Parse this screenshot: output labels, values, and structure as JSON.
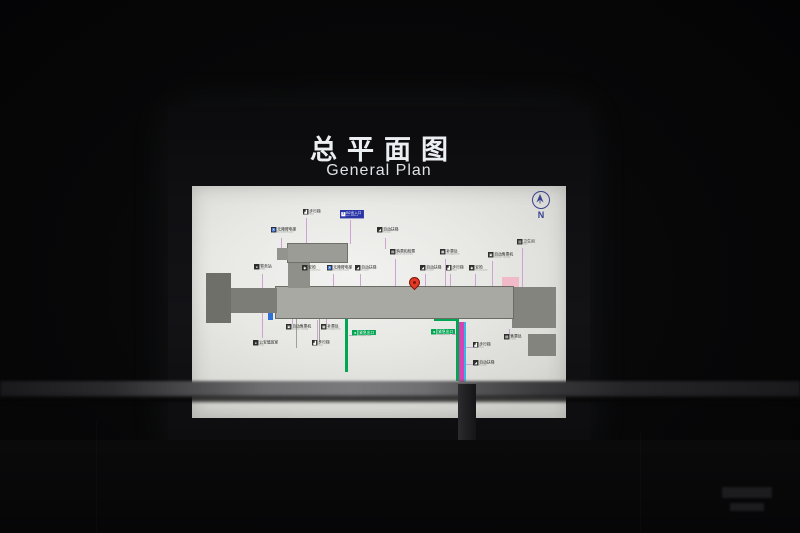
{
  "sign": {
    "title_zh": "总平面图",
    "title_en": "General Plan"
  },
  "compass": {
    "label": "N"
  },
  "colors": {
    "accent_green": "#00a651",
    "accent_magenta": "#d841b1",
    "accent_cyan": "#38b6e6",
    "accent_orange": "#f08424",
    "exit_blue": "#2a35a8",
    "pin_red": "#e23a26",
    "compass_blue": "#39418f"
  },
  "map": {
    "labels": [
      {
        "x": 303,
        "y": 209,
        "zh": "步行梯",
        "en": "Stairs",
        "icon": "stairs-icon",
        "style": "dark"
      },
      {
        "x": 340,
        "y": 210,
        "zh": "B2出入口",
        "en": "Exit / Entrance",
        "icon": "exit-badge-icon",
        "badge": "2",
        "style": "blue"
      },
      {
        "x": 271,
        "y": 227,
        "zh": "无障碍电梯",
        "en": "Accessible Elevator",
        "icon": "accessible-elevator-icon",
        "style": "dark"
      },
      {
        "x": 377,
        "y": 227,
        "zh": "自动扶梯",
        "en": "Escalator",
        "icon": "escalator-icon",
        "style": "dark"
      },
      {
        "x": 517,
        "y": 239,
        "zh": "卫生间",
        "en": "Toilet",
        "icon": "toilet-icon",
        "style": "dark"
      },
      {
        "x": 390,
        "y": 249,
        "zh": "购票和检票",
        "en": "Buy & Check Tickets",
        "icon": "ticket-check-icon",
        "style": "dark"
      },
      {
        "x": 440,
        "y": 249,
        "zh": "补票处",
        "en": "Fare Adjustment",
        "icon": "fare-adjust-icon",
        "style": "dark"
      },
      {
        "x": 488,
        "y": 252,
        "zh": "自动售票机",
        "en": "Automatic Ticketing",
        "icon": "ticket-machine-icon",
        "style": "dark"
      },
      {
        "x": 254,
        "y": 264,
        "zh": "警务站",
        "en": "Police",
        "icon": "police-icon",
        "style": "dark"
      },
      {
        "x": 302,
        "y": 265,
        "zh": "安检",
        "en": "Security Check",
        "icon": "security-check-icon",
        "style": "dark"
      },
      {
        "x": 327,
        "y": 265,
        "zh": "无障碍电梯",
        "en": "Accessible Elevator",
        "icon": "accessible-elevator-icon",
        "style": "dark"
      },
      {
        "x": 355,
        "y": 265,
        "zh": "自动扶梯",
        "en": "Escalator",
        "icon": "escalator-icon",
        "style": "dark"
      },
      {
        "x": 420,
        "y": 265,
        "zh": "自动扶梯",
        "en": "Escalator",
        "icon": "escalator-icon",
        "style": "dark"
      },
      {
        "x": 446,
        "y": 265,
        "zh": "步行梯",
        "en": "Stairs",
        "icon": "stairs-icon",
        "style": "dark"
      },
      {
        "x": 469,
        "y": 265,
        "zh": "安检",
        "en": "Security Check",
        "icon": "security-check-icon",
        "style": "dark"
      },
      {
        "x": 286,
        "y": 324,
        "zh": "自动售票机",
        "en": "Automatic Ticketing",
        "icon": "ticket-machine-icon",
        "style": "dark"
      },
      {
        "x": 321,
        "y": 324,
        "zh": "补票处",
        "en": "Fare Adjustment",
        "icon": "fare-adjust-icon",
        "style": "dark"
      },
      {
        "x": 253,
        "y": 340,
        "zh": "公安值班室",
        "en": "Police",
        "icon": "police-icon",
        "style": "dark"
      },
      {
        "x": 312,
        "y": 340,
        "zh": "步行梯",
        "en": "Stairs",
        "icon": "stairs-icon",
        "style": "dark"
      },
      {
        "x": 352,
        "y": 330,
        "zh": "紧急出口",
        "en": "Emergency Exit",
        "icon": "running-man-icon",
        "style": "green"
      },
      {
        "x": 431,
        "y": 329,
        "zh": "紧急出口",
        "en": "Emergency Exit",
        "icon": "running-man-icon",
        "style": "green"
      },
      {
        "x": 473,
        "y": 342,
        "zh": "步行梯",
        "en": "Stairs",
        "icon": "stairs-icon",
        "style": "dark"
      },
      {
        "x": 473,
        "y": 360,
        "zh": "自动扶梯",
        "en": "Escalator",
        "icon": "escalator-icon",
        "style": "dark"
      },
      {
        "x": 504,
        "y": 334,
        "zh": "售票处",
        "en": "Tickets",
        "icon": "ticket-office-icon",
        "style": "dark"
      }
    ],
    "icon_glyphs": {
      "stairs-icon": "▟",
      "exit-badge-icon": "2",
      "accessible-elevator-icon": "♿",
      "escalator-icon": "◢",
      "toilet-icon": "▥",
      "ticket-check-icon": "▤",
      "fare-adjust-icon": "▦",
      "ticket-machine-icon": "▣",
      "police-icon": "●",
      "security-check-icon": "◉",
      "running-man-icon": "◄",
      "ticket-office-icon": "▤"
    },
    "shapes": [
      {
        "name": "west-block",
        "x": 206,
        "y": 273,
        "w": 25,
        "h": 50,
        "f": "#6f6f69"
      },
      {
        "name": "west-walkway",
        "x": 230,
        "y": 288,
        "w": 47,
        "h": 25,
        "f": "#7d7d77"
      },
      {
        "name": "platform-west-stub",
        "x": 277,
        "y": 248,
        "w": 11,
        "h": 12,
        "f": "#94948e"
      },
      {
        "name": "platform-wing",
        "x": 288,
        "y": 244,
        "w": 59,
        "h": 18,
        "f": "#9c9c96",
        "s": "#70706a"
      },
      {
        "name": "platform-connector",
        "x": 288,
        "y": 261,
        "w": 22,
        "h": 27,
        "f": "#90908a"
      },
      {
        "name": "platform-edge-cyan",
        "x": 292,
        "y": 245,
        "w": 45,
        "h": 5,
        "f": "#38b6e6"
      },
      {
        "name": "platform-train-magenta",
        "x": 292,
        "y": 250,
        "w": 42,
        "h": 5,
        "f": "#d841b1"
      },
      {
        "name": "concourse",
        "x": 276,
        "y": 287,
        "w": 237,
        "h": 31,
        "f": "#a9a9a3",
        "s": "#6c6c66"
      },
      {
        "name": "east-block",
        "x": 512,
        "y": 287,
        "w": 44,
        "h": 41,
        "f": "#84847e"
      },
      {
        "name": "east-pink-room",
        "x": 502,
        "y": 277,
        "w": 17,
        "h": 11,
        "f": "#f0bac8"
      },
      {
        "name": "southeast-block",
        "x": 528,
        "y": 334,
        "w": 28,
        "h": 22,
        "f": "#84847e"
      },
      {
        "name": "south-corridor-wall",
        "x": 345,
        "y": 318,
        "w": 3,
        "h": 54,
        "f": "#00a651"
      },
      {
        "name": "exit-corridor-top",
        "x": 434,
        "y": 318,
        "w": 25,
        "h": 3,
        "f": "#00a651"
      },
      {
        "name": "exit-corridor-left",
        "x": 456,
        "y": 320,
        "w": 3,
        "h": 61,
        "f": "#00a651"
      },
      {
        "name": "exit-escalator",
        "x": 459,
        "y": 322,
        "w": 4.5,
        "h": 60,
        "f": "#d841b1"
      },
      {
        "name": "exit-escalator-edge",
        "x": 463.5,
        "y": 322,
        "w": 2,
        "h": 60,
        "f": "#38b6e6"
      },
      {
        "name": "gate-green-west",
        "x": 271,
        "y": 292,
        "w": 4,
        "h": 14,
        "f": "#00a651"
      },
      {
        "name": "booth-blue-west",
        "x": 268,
        "y": 309,
        "w": 5,
        "h": 11,
        "f": "#2f6fd8"
      },
      {
        "name": "tvm-magenta-west",
        "x": 316,
        "y": 299,
        "w": 17,
        "h": 6,
        "f": "#d841b1"
      },
      {
        "name": "kiosk-orange-west",
        "x": 337,
        "y": 306,
        "w": 5,
        "h": 5,
        "f": "#f08424"
      },
      {
        "name": "fare-gates-west",
        "x": 352,
        "y": 299,
        "w": 17,
        "h": 5,
        "f": "#38b6e6"
      },
      {
        "name": "fare-gates-east",
        "x": 420,
        "y": 299,
        "w": 14,
        "h": 6,
        "f": "#38b6e6"
      },
      {
        "name": "kiosk-orange-east",
        "x": 443,
        "y": 303,
        "w": 5,
        "h": 5,
        "f": "#f08424"
      },
      {
        "name": "tvm-magenta-east",
        "x": 448,
        "y": 298,
        "w": 14,
        "h": 6,
        "f": "#d841b1"
      },
      {
        "name": "gate-green-east",
        "x": 506,
        "y": 293,
        "w": 4,
        "h": 15,
        "f": "#00a651"
      },
      {
        "name": "gate-blue-a",
        "x": 293,
        "y": 296,
        "w": 6,
        "h": 4,
        "f": "#38b6e6"
      },
      {
        "name": "gate-blue-b",
        "x": 308,
        "y": 286,
        "w": 7,
        "h": 5,
        "f": "#5b8dd8"
      },
      {
        "name": "gate-blue-c",
        "x": 383,
        "y": 290,
        "w": 6,
        "h": 5,
        "f": "#5b8dd8"
      },
      {
        "name": "booth-gray",
        "x": 401,
        "y": 291,
        "w": 5,
        "h": 5,
        "f": "#9aa4b4"
      },
      {
        "name": "corridor-line-a",
        "x": 296,
        "y": 318,
        "w": 1,
        "h": 30,
        "f": "#a0a09a"
      },
      {
        "name": "corridor-line-b",
        "x": 319,
        "y": 318,
        "w": 1,
        "h": 24,
        "f": "#a0a09a"
      }
    ],
    "leaders": [
      {
        "x": 306,
        "y": 218,
        "dir": "v",
        "len": 26
      },
      {
        "x": 350,
        "y": 220,
        "dir": "v",
        "len": 24
      },
      {
        "x": 281,
        "y": 238,
        "dir": "v",
        "len": 12
      },
      {
        "x": 385,
        "y": 238,
        "dir": "v",
        "len": 11
      },
      {
        "x": 522,
        "y": 248,
        "dir": "v",
        "len": 39
      },
      {
        "x": 395,
        "y": 259,
        "dir": "v",
        "len": 40
      },
      {
        "x": 445,
        "y": 259,
        "dir": "v",
        "len": 39
      },
      {
        "x": 492,
        "y": 261,
        "dir": "v",
        "len": 32
      },
      {
        "x": 262,
        "y": 274,
        "dir": "v",
        "len": 64
      },
      {
        "x": 307,
        "y": 274,
        "dir": "v",
        "len": 14
      },
      {
        "x": 333,
        "y": 274,
        "dir": "v",
        "len": 24
      },
      {
        "x": 360,
        "y": 274,
        "dir": "v",
        "len": 16
      },
      {
        "x": 425,
        "y": 274,
        "dir": "v",
        "len": 18
      },
      {
        "x": 450,
        "y": 274,
        "dir": "v",
        "len": 18
      },
      {
        "x": 475,
        "y": 274,
        "dir": "v",
        "len": 18
      },
      {
        "x": 292,
        "y": 312,
        "dir": "v",
        "len": 12
      },
      {
        "x": 326,
        "y": 312,
        "dir": "v",
        "len": 12
      },
      {
        "x": 317,
        "y": 320,
        "dir": "v",
        "len": 20
      },
      {
        "x": 349,
        "y": 335,
        "dir": "h",
        "len": 4
      },
      {
        "x": 452,
        "y": 334,
        "dir": "h",
        "len": 5
      },
      {
        "x": 464,
        "y": 347,
        "dir": "h",
        "len": 9
      },
      {
        "x": 464,
        "y": 364,
        "dir": "h",
        "len": 9
      },
      {
        "x": 509,
        "y": 329,
        "dir": "v",
        "len": 6
      }
    ],
    "columns": {
      "x0": 281.5,
      "spacing": 8.2,
      "count": 28,
      "rows": [
        294,
        310.5
      ]
    }
  }
}
